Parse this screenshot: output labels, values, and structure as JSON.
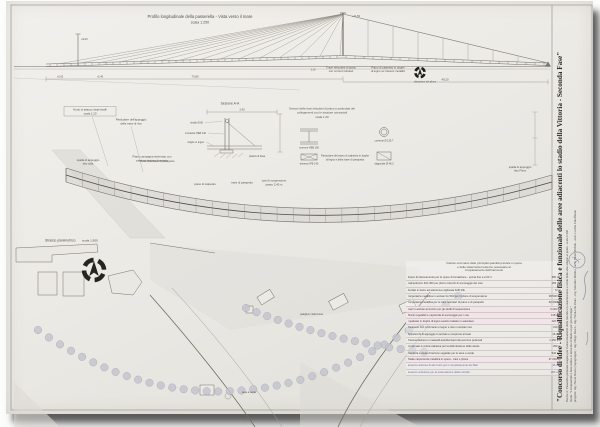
{
  "elevation": {
    "title": "Profilo longitudinale della passerella - Vista verso il mare",
    "scale": "scala 1:250",
    "dim_mast": "+21,50",
    "dim_small_mast": "+9,00",
    "dim_deck": "+2,40",
    "dim_zero": "+0,00",
    "dim_span_left": "73,80",
    "dim_span_right": "49,20",
    "scale_note": "1:10",
    "label_truss_1": "Trave reticolare di piano",
    "label_truss_2": "con correnti tubolari",
    "label_deck_1": "Piano di calpestio in doghe",
    "label_deck_2": "di legno su traversi metallici",
    "label_symbol": "ubicazione del pilone"
  },
  "details": {
    "box1_line1": "Nodo di attacco degli stralli",
    "box1_line2": "scala 1:20",
    "box2_line1": "Particolare dell'appoggio",
    "box2_line2": "della trave di riva",
    "ground_label_1": "Piano campagna sistemato con",
    "ground_label_2": "pavimentazione drenante",
    "section_label": "Sezione A-A",
    "section_dim": "2,40",
    "leader_1": "strallo Ø 60",
    "leader_2": "montante HEB 140",
    "leader_3": "doghe in legno",
    "leader_4": "piastra di base",
    "center_title_1": "Sezioni delle travi reticolari di piano e particolari dei",
    "center_title_2": "collegamenti con le strutture orizzontali",
    "center_title_3": "scala 1:20",
    "det_a_caption": "corrente HEB 160",
    "det_a2_caption": "traverso IPE 140",
    "det_b_caption": "corrente Ø 139,7",
    "det_b2_caption": "diagonale Ø 48,3",
    "caption_low_1": "Particolare del piano di calpestio in doghe",
    "caption_low_2": "di legno e della trave di parapetto"
  },
  "plan": {
    "label_top": "Trave reticolare di parapetto",
    "label_deck": "piano di calpestio",
    "label_parapet": "trave di parapetto",
    "label_cables_1": "cavi di sospensione",
    "label_cables_2": "passo 2,40 m",
    "label_left_1": "spalla di appoggio",
    "label_left_2": "lato città",
    "label_right_1": "spalla di appoggio",
    "label_right_2": "lato Fiera"
  },
  "siteplan": {
    "title": "Stralcio planimetrico",
    "scale": "scala 1:500",
    "label_pavilions": "padiglioni della Fiera",
    "label_green": "area a verde"
  },
  "table": {
    "header_lines": [
      "Calcolo sommario delle principali quantità previste in opera",
      "e delle sistemazioni esterne necessarie al",
      "completamento dell'intervento"
    ],
    "rows": [
      {
        "desc": "Scavo di sbancamento per le opere di fondazione - spinta fino a 2,00 m",
        "val": "380 mc",
        "style": ""
      },
      {
        "desc": "Calcestruzzo Rck 300 per plinti e blocchi di ancoraggio dei cavi",
        "val": "165 mc",
        "style": ""
      },
      {
        "desc": "Acciaio in barre ad aderenza migliorata FeB 44k",
        "val": "72 ql",
        "style": ""
      },
      {
        "desc": "Carpenteria metallica in acciaio Fe 510 per il pilone di sospensione",
        "val": "38.500 kg",
        "style": ""
      },
      {
        "desc": "Carpenteria metallica per le travi reticolari di piano e di parapetto",
        "val": "52.300 kg",
        "style": ""
      },
      {
        "desc": "Cavi in acciaio armonico per gli stralli di sospensione",
        "val": "6.240 kg",
        "style": "pink"
      },
      {
        "desc": "Tiranti regolabili e capicorda di ancoraggio per i cavi",
        "val": "128 cad",
        "style": "pink"
      },
      {
        "desc": "Impalcato in doghe di legno esotico trattato in autoclave",
        "val": "420 mq",
        "style": "pink"
      },
      {
        "desc": "Parapetto con corrimano in legno e rete in acciaio inox",
        "val": "310 m",
        "style": ""
      },
      {
        "desc": "Apparecchi di appoggio in acciaio e neoprene armato",
        "val": "16 cad",
        "style": ""
      },
      {
        "desc": "Pavimentazione in masselli autobloccanti dei percorsi pedonali",
        "val": "1.150 mq",
        "style": ""
      },
      {
        "desc": "Cordonate in pietra calcarea per la delimitazione delle aiuole",
        "val": "360 m",
        "style": ""
      },
      {
        "desc": "Fornitura e stesa di terreno vegetale per le aree a verde",
        "val": "540 mc",
        "style": ""
      },
      {
        "desc": "Totale carpenteria metallica in opera - travi e pilone",
        "val": "97.040 kg",
        "style": "pink"
      },
      {
        "desc": "Essenze arboree di alto fusto per il completamento dei filari",
        "val": "46 cad",
        "style": "violet"
      },
      {
        "desc": "Essenze arbustive per la sistemazione della rotonda",
        "val": "280 cad",
        "style": "violet"
      }
    ]
  },
  "titleblock": {
    "main_title": "\"Concorso di Idee - Riqualificazione fisica e funzionale delle aree adiacenti lo stadio della Vittoria - Seconda Fase\"",
    "line2": "Tavola 4 / Passerella pedonale sospesa per l'attraversamento della rotonda e la sistemazione a verde delle aree attigue al ponte - scala 1:200",
    "line3": "motto: \"L'impossibile è fatto subito, il miracolo richiede un po' più di tempo\"",
    "line4": "progetto: ing. Flavio Bosco (capogruppo) - ing. Diego Bosco - ing. Nicola De Paolo - ing. Maurilio Milella - arch. Paolo Perfido - arch. Lucilla Chiaffitano"
  }
}
